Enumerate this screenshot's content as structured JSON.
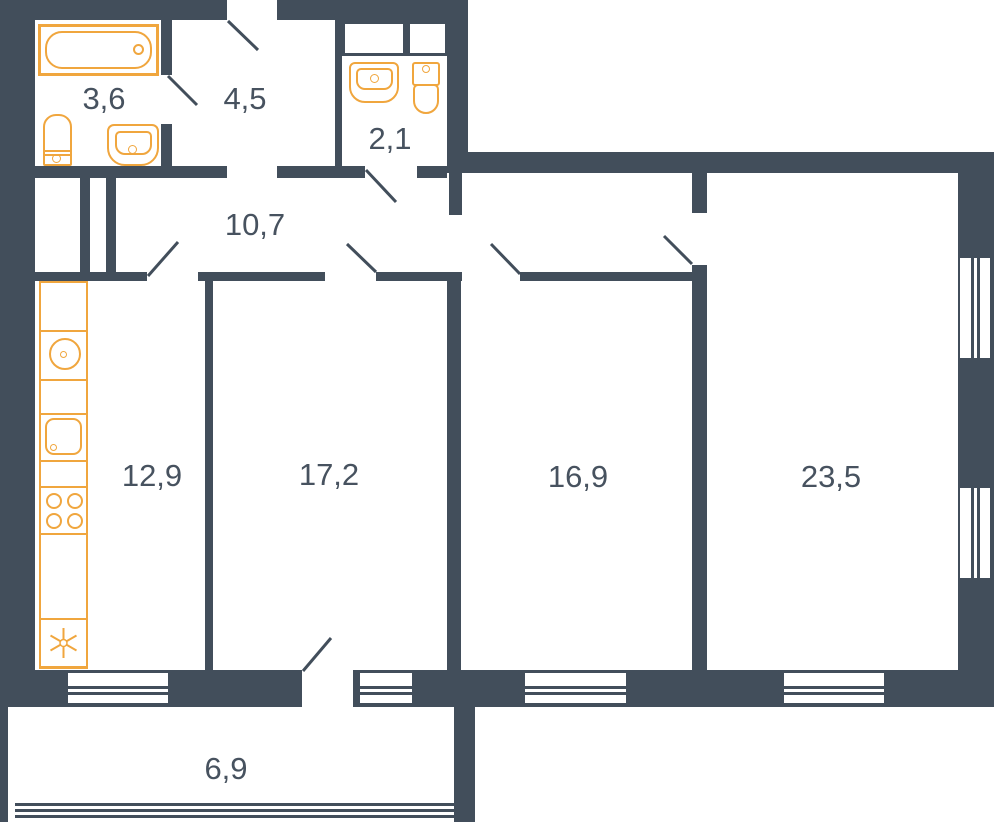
{
  "plan": {
    "type": "apartment-floor-plan",
    "rooms": {
      "bathroom": {
        "label": "3,6"
      },
      "entry_hall": {
        "label": "4,5"
      },
      "wc": {
        "label": "2,1"
      },
      "corridor": {
        "label": "10,7"
      },
      "kitchen": {
        "label": "12,9"
      },
      "room_a": {
        "label": "17,2"
      },
      "room_b": {
        "label": "16,9"
      },
      "room_c": {
        "label": "23,5"
      },
      "balcony": {
        "label": "6,9"
      }
    },
    "fixtures": [
      "bathtub",
      "water-heater",
      "washbasin",
      "wc-washbasin",
      "toilet",
      "washing-machine",
      "kitchen-sink",
      "stove",
      "refrigerator"
    ],
    "colors": {
      "walls": "#424E5B",
      "fixtures": "#F0A63E",
      "labels": "#47525F",
      "background": "#FFFFFF"
    }
  }
}
